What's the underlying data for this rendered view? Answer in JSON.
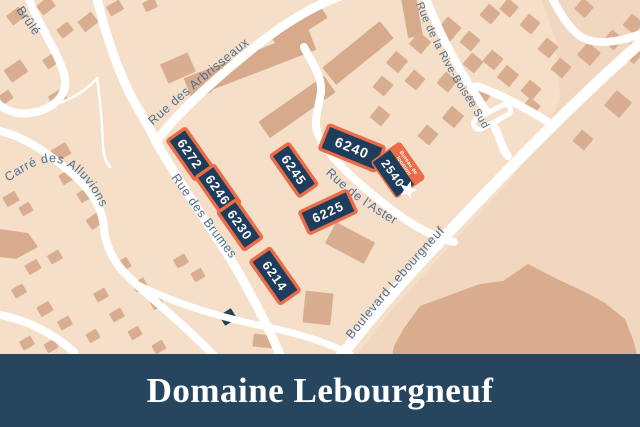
{
  "banner": {
    "title": "Domaine Lebourgneuf",
    "bg": "#26465f",
    "text_color": "#ffffff"
  },
  "map": {
    "colors": {
      "bg": "#f5dfc9",
      "block_shade": "#f1d7bf",
      "terrain": "#d9ac8e",
      "house": "#d9ae90",
      "slab": "#d7aa8c",
      "road": "#ffffff",
      "navy": "#1e3c5b",
      "orange": "#ec6c47",
      "label": "#4e6e90",
      "star": "#ffffff",
      "dark_building": "#24415c"
    },
    "shade_polygons": [
      "540,-4 646,-4 646,356 356,356 392,310 430,268 470,224 510,180 540,140 560,100 556,40"
    ],
    "hill_polygon": "394,346 404,328 420,306 450,295 480,284 503,281 528,264 557,279 585,292 605,303 625,319 634,342 637,356 392,356",
    "corner_polygon": "0,229 28,233 38,247 16,259 0,257",
    "slabs_cxcywhr": [
      [
        250,
        64,
        134,
        21,
        -21
      ],
      [
        297,
        107,
        80,
        20,
        -35
      ],
      [
        298,
        25,
        58,
        20,
        -33
      ],
      [
        358,
        53,
        74,
        22,
        -39
      ],
      [
        412,
        17,
        15,
        40,
        -10
      ]
    ],
    "houses_cxcywhr": [
      [
        16,
        16,
        16,
        12,
        -38
      ],
      [
        46,
        6,
        16,
        12,
        -38
      ],
      [
        65,
        30,
        14,
        11,
        -38
      ],
      [
        88,
        22,
        17,
        13,
        -38
      ],
      [
        115,
        8,
        15,
        11,
        -30
      ],
      [
        150,
        5,
        13,
        10,
        -25
      ],
      [
        16,
        71,
        20,
        15,
        -35
      ],
      [
        51,
        61,
        14,
        11,
        -35
      ],
      [
        58,
        98,
        16,
        13,
        -32
      ],
      [
        6,
        97,
        12,
        10,
        -35
      ],
      [
        178,
        68,
        30,
        21,
        -24
      ],
      [
        200,
        89,
        21,
        15,
        -24
      ],
      [
        61,
        152,
        17,
        13,
        -30
      ],
      [
        67,
        177,
        14,
        11,
        -30
      ],
      [
        85,
        195,
        14,
        11,
        -30
      ],
      [
        11,
        199,
        14,
        11,
        -30
      ],
      [
        26,
        209,
        12,
        10,
        -30
      ],
      [
        95,
        221,
        15,
        12,
        -35
      ],
      [
        33,
        267,
        14,
        11,
        -30
      ],
      [
        55,
        257,
        13,
        10,
        -30
      ],
      [
        19,
        291,
        13,
        10,
        -30
      ],
      [
        45,
        309,
        14,
        11,
        -30
      ],
      [
        65,
        323,
        13,
        10,
        -30
      ],
      [
        27,
        343,
        13,
        10,
        -30
      ],
      [
        51,
        346,
        12,
        10,
        -30
      ],
      [
        123,
        265,
        14,
        11,
        -30
      ],
      [
        140,
        285,
        13,
        10,
        -30
      ],
      [
        157,
        303,
        12,
        10,
        -30
      ],
      [
        101,
        295,
        13,
        10,
        -30
      ],
      [
        117,
        315,
        13,
        10,
        -30
      ],
      [
        135,
        333,
        12,
        10,
        -30
      ],
      [
        93,
        336,
        12,
        10,
        -30
      ],
      [
        159,
        347,
        12,
        10,
        -30
      ],
      [
        181,
        261,
        13,
        10,
        -30
      ],
      [
        198,
        275,
        12,
        10,
        -30
      ],
      [
        318,
        308,
        28,
        32,
        6
      ],
      [
        263,
        341,
        20,
        13,
        6
      ],
      [
        350,
        243,
        44,
        24,
        28
      ]
    ],
    "dark_house_cxcywhr": [
      228,
      317,
      14,
      12,
      -32
    ],
    "diamonds_cxcys": [
      [
        449,
        29,
        18
      ],
      [
        470,
        41,
        15
      ],
      [
        420,
        43,
        16
      ],
      [
        397,
        62,
        16
      ],
      [
        383,
        86,
        15
      ],
      [
        415,
        80,
        15
      ],
      [
        447,
        82,
        15
      ],
      [
        473,
        63,
        15
      ],
      [
        380,
        116,
        15
      ],
      [
        453,
        117,
        16
      ],
      [
        428,
        135,
        15
      ],
      [
        480,
        97,
        15
      ],
      [
        490,
        14,
        15
      ],
      [
        509,
        8,
        14
      ],
      [
        530,
        24,
        15
      ],
      [
        548,
        48,
        15
      ],
      [
        584,
        8,
        14
      ],
      [
        613,
        40,
        15
      ],
      [
        633,
        24,
        15
      ],
      [
        589,
        54,
        17
      ],
      [
        561,
        68,
        15
      ],
      [
        633,
        53,
        16
      ],
      [
        493,
        60,
        15
      ],
      [
        508,
        76,
        16
      ],
      [
        531,
        90,
        15
      ],
      [
        618,
        104,
        20
      ],
      [
        583,
        140,
        15
      ],
      [
        531,
        107,
        14
      ]
    ],
    "roads": [
      {
        "id": "rue-brule",
        "d": "M 27 -6 C 38 25 58 52 64 74 C 70 96 52 110 30 113 C 16 115 4 110 -4 102",
        "w": 8
      },
      {
        "id": "north-access",
        "d": "M 96 -6 C 104 30 120 80 140 112 C 147 124 152 132 156 142",
        "w": 9
      },
      {
        "id": "rue-des-arbrisseaux",
        "d": "M 156 142 C 176 114 216 78 256 46 C 286 22 322 0 354 -8",
        "w": 9
      },
      {
        "id": "rue-des-brumes",
        "d": "M 156 142 C 176 176 202 216 226 252 C 244 280 260 312 270 332 C 275 343 278 350 281 358",
        "w": 9
      },
      {
        "id": "carre-des-alluvions",
        "d": "M -4 130 C 24 136 46 152 68 170 C 90 188 102 206 104 228 C 106 252 118 268 136 284 C 158 304 190 330 216 358",
        "w": 8
      },
      {
        "id": "southwest-road",
        "d": "M -4 314 C 28 320 54 334 74 352",
        "w": 8
      },
      {
        "id": "south-connector",
        "d": "M 140 286 C 185 308 232 320 272 328 C 304 335 330 344 350 354",
        "w": 7
      },
      {
        "id": "rue-de-l-aster",
        "d": "M 304 47 C 311 62 322 74 321 92 C 319 108 312 122 319 136 C 331 160 356 182 392 210 C 416 228 436 238 454 242",
        "w": 8
      },
      {
        "id": "boulevard-lebourgneuf",
        "d": "M 338 360 C 366 324 396 288 432 250 C 462 218 502 176 536 142 C 570 108 612 68 646 38",
        "w": 11
      },
      {
        "id": "rue-de-la-rive-boisee-sud",
        "d": "M 424 -6 C 436 24 452 58 470 86 C 483 106 494 122 500 140 C 503 148 505 153 508 156",
        "w": 8
      },
      {
        "id": "rive-boisee-branch",
        "d": "M 477 86 C 504 96 530 110 554 126",
        "w": 8
      },
      {
        "id": "northeast-road",
        "d": "M 550 -6 C 560 14 569 28 580 36 C 593 45 616 44 646 32",
        "w": 8
      },
      {
        "id": "lane-west",
        "d": "M 97 78 C 82 96 55 108 18 114",
        "w": 2.5
      },
      {
        "id": "lane-center",
        "d": "M 97 78 C 100 98 102 124 103 144 C 103 154 105 161 110 167",
        "w": 2.5
      }
    ],
    "median_island": {
      "cx": 492,
      "cy": 117,
      "w": 11,
      "h": 40,
      "rot": 62
    },
    "streets": [
      {
        "name": "Brûlé",
        "x": 16,
        "y": 10,
        "deg": 55
      },
      {
        "name": "Carré des Alluvions",
        "d": "M 8 182 C 28 168 46 158 62 164 C 82 172 96 194 106 220",
        "off": 0
      },
      {
        "name": "Rue des Arbrisseaux",
        "d": "M 150 128 C 186 96 228 60 278 22",
        "off": 4
      },
      {
        "name": "Rue des Brumes",
        "d": "M 170 176 C 190 204 212 236 240 270",
        "off": 2
      },
      {
        "name": "Rue de l'Aster",
        "d": "M 324 172 C 344 193 370 211 402 229 C 416 237 430 243 446 248",
        "off": 2
      },
      {
        "name": "Rue de la Rive-Boisée Sud",
        "d": "M 416 4 C 428 34 444 66 462 94 C 472 110 481 124 488 138",
        "off": 0,
        "small": true
      },
      {
        "name": "Boulevard Lebourgneuf",
        "d": "M 348 344 C 374 312 402 278 436 241 C 466 209 492 184 514 162",
        "off": 6
      }
    ],
    "buildings": [
      {
        "number": "6272",
        "cx": 190,
        "cy": 154,
        "w": 48,
        "h": 22,
        "rot": 55,
        "fs": 13
      },
      {
        "number": "6246",
        "cx": 218,
        "cy": 190,
        "w": 46,
        "h": 22,
        "rot": 55,
        "fs": 13
      },
      {
        "number": "6230",
        "cx": 240,
        "cy": 225,
        "w": 46,
        "h": 22,
        "rot": 55,
        "fs": 13
      },
      {
        "number": "6214",
        "cx": 275,
        "cy": 276,
        "w": 52,
        "h": 24,
        "rot": 55,
        "fs": 13
      },
      {
        "number": "6245",
        "cx": 294,
        "cy": 170,
        "w": 50,
        "h": 22,
        "rot": 55,
        "fs": 13
      },
      {
        "number": "6225",
        "cx": 328,
        "cy": 212,
        "w": 52,
        "h": 24,
        "rot": -25,
        "fs": 13
      },
      {
        "number": "6240",
        "cx": 352,
        "cy": 148,
        "w": 60,
        "h": 26,
        "rot": 22,
        "fs": 14
      }
    ],
    "office": {
      "number": "2540",
      "tag_line1": "Bureau de",
      "tag_line2": "location",
      "cx": 398,
      "cy": 170,
      "w": 42,
      "h": 33,
      "tag_h": 11.5,
      "rot": 55,
      "fs": 12,
      "star": {
        "x": 408,
        "y": 190,
        "r1": 9.5,
        "r2": 4,
        "rot": 18
      }
    }
  }
}
